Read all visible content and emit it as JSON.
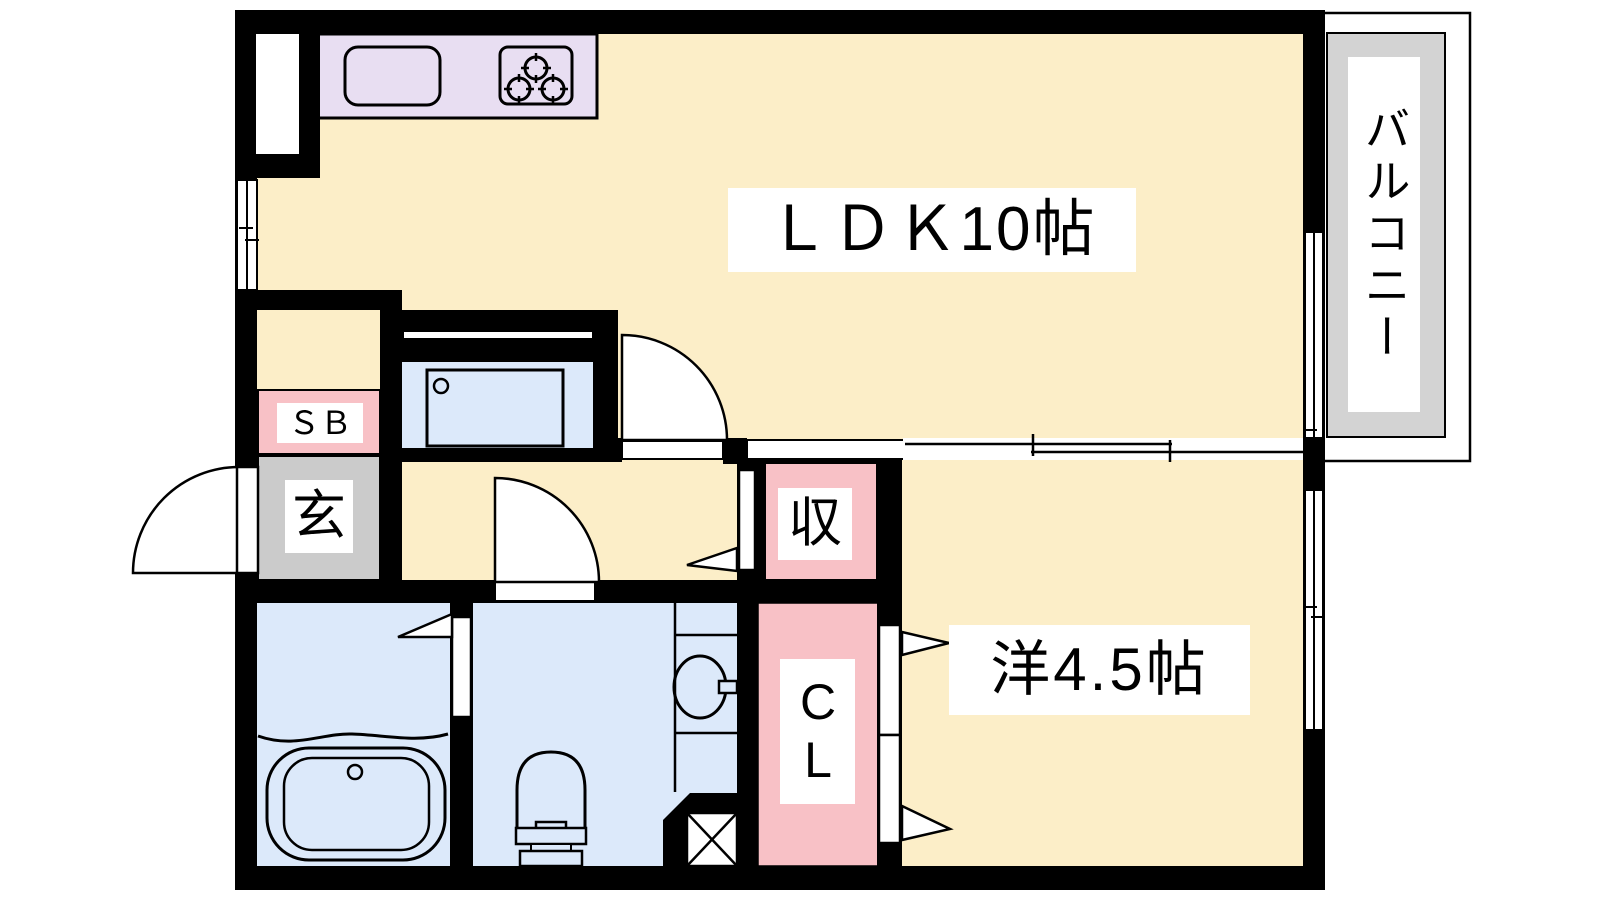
{
  "floorplan": {
    "title": "1LDK apartment floor plan",
    "rooms": {
      "ldk": {
        "label": "ＬＤＫ10帖"
      },
      "western": {
        "label": "洋4.5帖"
      },
      "balcony": {
        "label": "バルコニー"
      },
      "shoe_box": {
        "label": "ＳＢ"
      },
      "entrance": {
        "label": "玄"
      },
      "storage": {
        "label": "収"
      },
      "closet": {
        "label": "CL"
      }
    },
    "fixtures": [
      "kitchen-sink",
      "three-burner-stove",
      "washing-machine-pan",
      "bathtub",
      "toilet",
      "wash-basin",
      "pipe-space"
    ],
    "colors": {
      "wall": "#000000",
      "floor": "#FCEEC8",
      "kitchen_counter": "#E8DEF2",
      "wet_area": "#DCE9FA",
      "storage_pink": "#F8C1C6",
      "entrance_gray": "#CBCBCB",
      "balcony_gray": "#D3D3D3",
      "label_bg": "#FFFFFF",
      "line": "#000000"
    }
  }
}
